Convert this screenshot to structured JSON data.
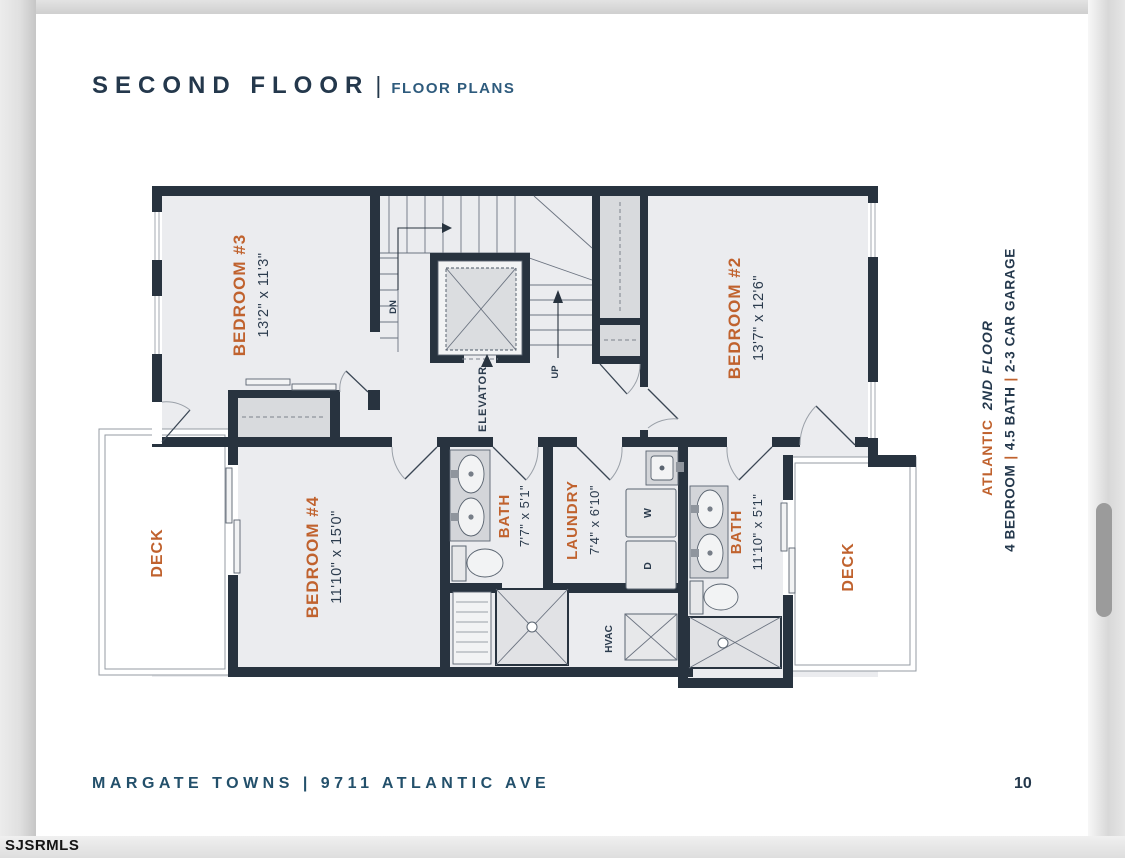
{
  "colors": {
    "accent_orange": "#C0622E",
    "navy": "#24384C",
    "subtitle_blue": "#2E5B7D",
    "wall": "#28333F"
  },
  "header": {
    "title": "SECOND FLOOR",
    "separator": "|",
    "subtitle": "FLOOR PLANS"
  },
  "plan_note": {
    "name": "ATLANTIC",
    "floor": "2ND FLOOR",
    "separator": "|",
    "specs": [
      "4 BEDROOM",
      "4.5 BATH",
      "2-3 CAR GARAGE"
    ]
  },
  "floorplan": {
    "rooms": {
      "bedroom3": {
        "name": "BEDROOM #3",
        "dims": "13'2\" x 11'3\""
      },
      "bedroom2": {
        "name": "BEDROOM #2",
        "dims": "13'7\" x 12'6\""
      },
      "bedroom4": {
        "name": "BEDROOM #4",
        "dims": "11'10\" x 15'0\""
      },
      "bath_center": {
        "name": "BATH",
        "dims": "7'7\" x 5'1\""
      },
      "laundry": {
        "name": "LAUNDRY",
        "dims": "7'4\" x 6'10\""
      },
      "bath_right": {
        "name": "BATH",
        "dims": "11'10\" x 5'1\""
      },
      "deck_left": {
        "name": "DECK"
      },
      "deck_right": {
        "name": "DECK"
      }
    },
    "annotations": {
      "elevator": "ELEVATOR",
      "down": "DN",
      "up": "UP",
      "hvac": "HVAC",
      "washer": "W",
      "dryer": "D"
    }
  },
  "footer": {
    "address": "MARGATE TOWNS | 9711 ATLANTIC AVE",
    "page_number": "10"
  },
  "watermark": "SJSRMLS"
}
